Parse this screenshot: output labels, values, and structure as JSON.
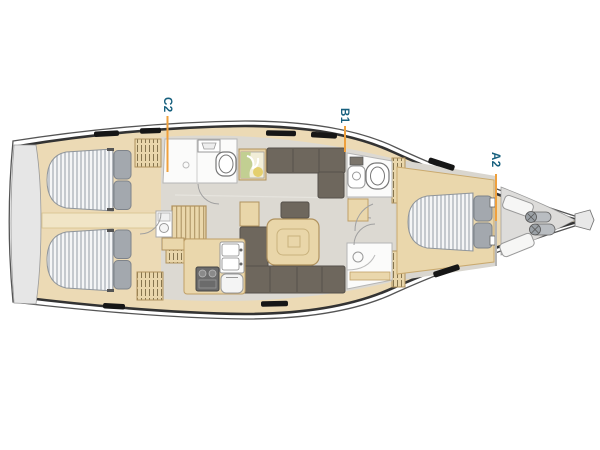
{
  "diagram": {
    "kind": "sailing-yacht-interior-layout-top-view",
    "labels": [
      {
        "id": "c2",
        "text": "C2"
      },
      {
        "id": "b1",
        "text": "B1"
      },
      {
        "id": "a2",
        "text": "A2"
      }
    ],
    "colors": {
      "label_text": "#17607e",
      "leader_line": "#efa03c",
      "hull_outline": "#3a3a3a",
      "deck_wood": "#ecdab5",
      "interior_floor": "#dcd9d2",
      "upholstery": "#6e675d",
      "mattress_stripe": "#b9bec4",
      "pillow_gray": "#a3a8ae",
      "swim_platform_gray": "#e6e6e6",
      "fixture_white": "#fbfbfa"
    }
  }
}
